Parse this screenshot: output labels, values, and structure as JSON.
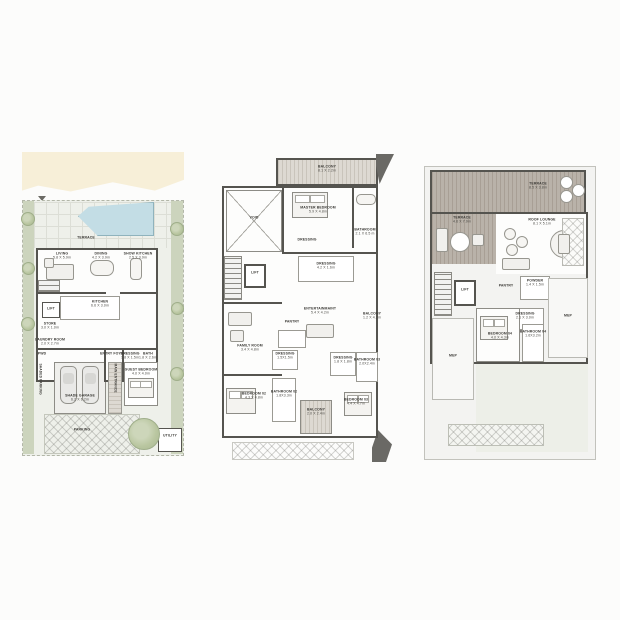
{
  "colors": {
    "wall": "#55544f",
    "beach_sand": "#f7efd8",
    "pool_water": "#c3dde5",
    "site_ground": "#eef0ea",
    "landscape_green": "#ccd4bd",
    "terrace_deck": "#b9b2a9",
    "floor_white": "#fdfdfc",
    "label_text": "#3c3b37"
  },
  "plans": {
    "ground": {
      "rooms": {
        "terrace": {
          "name": "TERRACE"
        },
        "living": {
          "name": "LIVING",
          "dims": "5.8 X 5.9m"
        },
        "dining": {
          "name": "DINING",
          "dims": "4.2 X 3.9m"
        },
        "show_kitchen": {
          "name": "SHOW KITCHEN",
          "dims": "2.5 X 3.9m"
        },
        "kitchen": {
          "name": "KITCHEN",
          "dims": "6.6 X 3.0m"
        },
        "lift": {
          "name": "LIFT"
        },
        "store": {
          "name": "STORE",
          "dims": "3.0 X 1.0m"
        },
        "laundry": {
          "name": "LAUNDRY ROOM",
          "dims": "2.0 X 2.7m"
        },
        "pwd": {
          "name": "PWD"
        },
        "entry_foyer": {
          "name": "ENTRY FOYER"
        },
        "dressing": {
          "name": "DRESSING",
          "dims": "1.8 X 1.5m"
        },
        "bath": {
          "name": "BATH",
          "dims": "1.8 X 2.6m"
        },
        "shade_garage": {
          "name": "SHADE GARAGE",
          "dims": "6.2 X 6.2m"
        },
        "main_entrance": {
          "name": "MAIN ENTRANCE"
        },
        "guest_bedroom": {
          "name": "GUEST BEDROOM",
          "dims": "4.0 X 4.0m"
        },
        "parking": {
          "name": "PARKING"
        },
        "shaded_parking": {
          "name": "SHADED PARKING"
        },
        "utility": {
          "name": "UTILITY"
        }
      }
    },
    "first": {
      "rooms": {
        "balcony_top": {
          "name": "BALCONY",
          "dims": "8.1 X 2.2m"
        },
        "void": {
          "name": "VOID"
        },
        "master_bedroom": {
          "name": "MASTER BEDROOM",
          "dims": "5.9 X 4.8m"
        },
        "dressing_a": {
          "name": "DRESSING"
        },
        "bathroom": {
          "name": "BATHROOM",
          "dims": "2.1 X 6.5 m"
        },
        "dressing_b": {
          "name": "DRESSING",
          "dims": "4.2 X 1.6m"
        },
        "lift": {
          "name": "LIFT"
        },
        "entertainment": {
          "name": "ENTERTAINMAINT",
          "dims": "5.4 X 4.2m"
        },
        "balcony_right": {
          "name": "BALCONY",
          "dims": "1.2 X 4.2m"
        },
        "pantry": {
          "name": "PANTRY"
        },
        "family_room": {
          "name": "FAMILY ROOM",
          "dims": "3.4 X 4.8m"
        },
        "dressing_c": {
          "name": "DRESSING",
          "dims": "1.5X1.5m"
        },
        "dressing_d": {
          "name": "DRESSING",
          "dims": "1.8 X 1.8m"
        },
        "bathroom_03": {
          "name": "BATHROOM 03",
          "dims": "2.0X2.4m"
        },
        "bedroom_02": {
          "name": "BEDROOM 02",
          "dims": "4.3 X 4.8m"
        },
        "bathroom_02": {
          "name": "BATHROOM 02",
          "dims": "1.8X3.3m"
        },
        "balcony_bottom": {
          "name": "BALCONY",
          "dims": "2.0 X 2.4m"
        },
        "bedroom_03": {
          "name": "BEDROOM 03",
          "dims": "4.4 X 4.7m"
        }
      }
    },
    "roof": {
      "rooms": {
        "terrace_top": {
          "name": "TERRACE",
          "dims": "8.5 X 3.8m"
        },
        "terrace_left": {
          "name": "TERRACE",
          "dims": "4.6 X 7.9m"
        },
        "roof_lounge": {
          "name": "ROOF LOUNGE",
          "dims": "8.1 X 5.1m"
        },
        "lift": {
          "name": "LIFT"
        },
        "pantry": {
          "name": "PANTRY"
        },
        "powder": {
          "name": "POWDER",
          "dims": "1.4 X 1.5m"
        },
        "dressing": {
          "name": "DRESSING",
          "dims": "2.1 X 3.0m"
        },
        "bedroom_04": {
          "name": "BEDROOM 04",
          "dims": "4.0 X 4.3m"
        },
        "bathroom_04": {
          "name": "BATHROOM 04",
          "dims": "1.6X3.2m"
        },
        "mep_left": {
          "name": "MEP"
        },
        "mep_right": {
          "name": "MEP"
        }
      }
    }
  }
}
